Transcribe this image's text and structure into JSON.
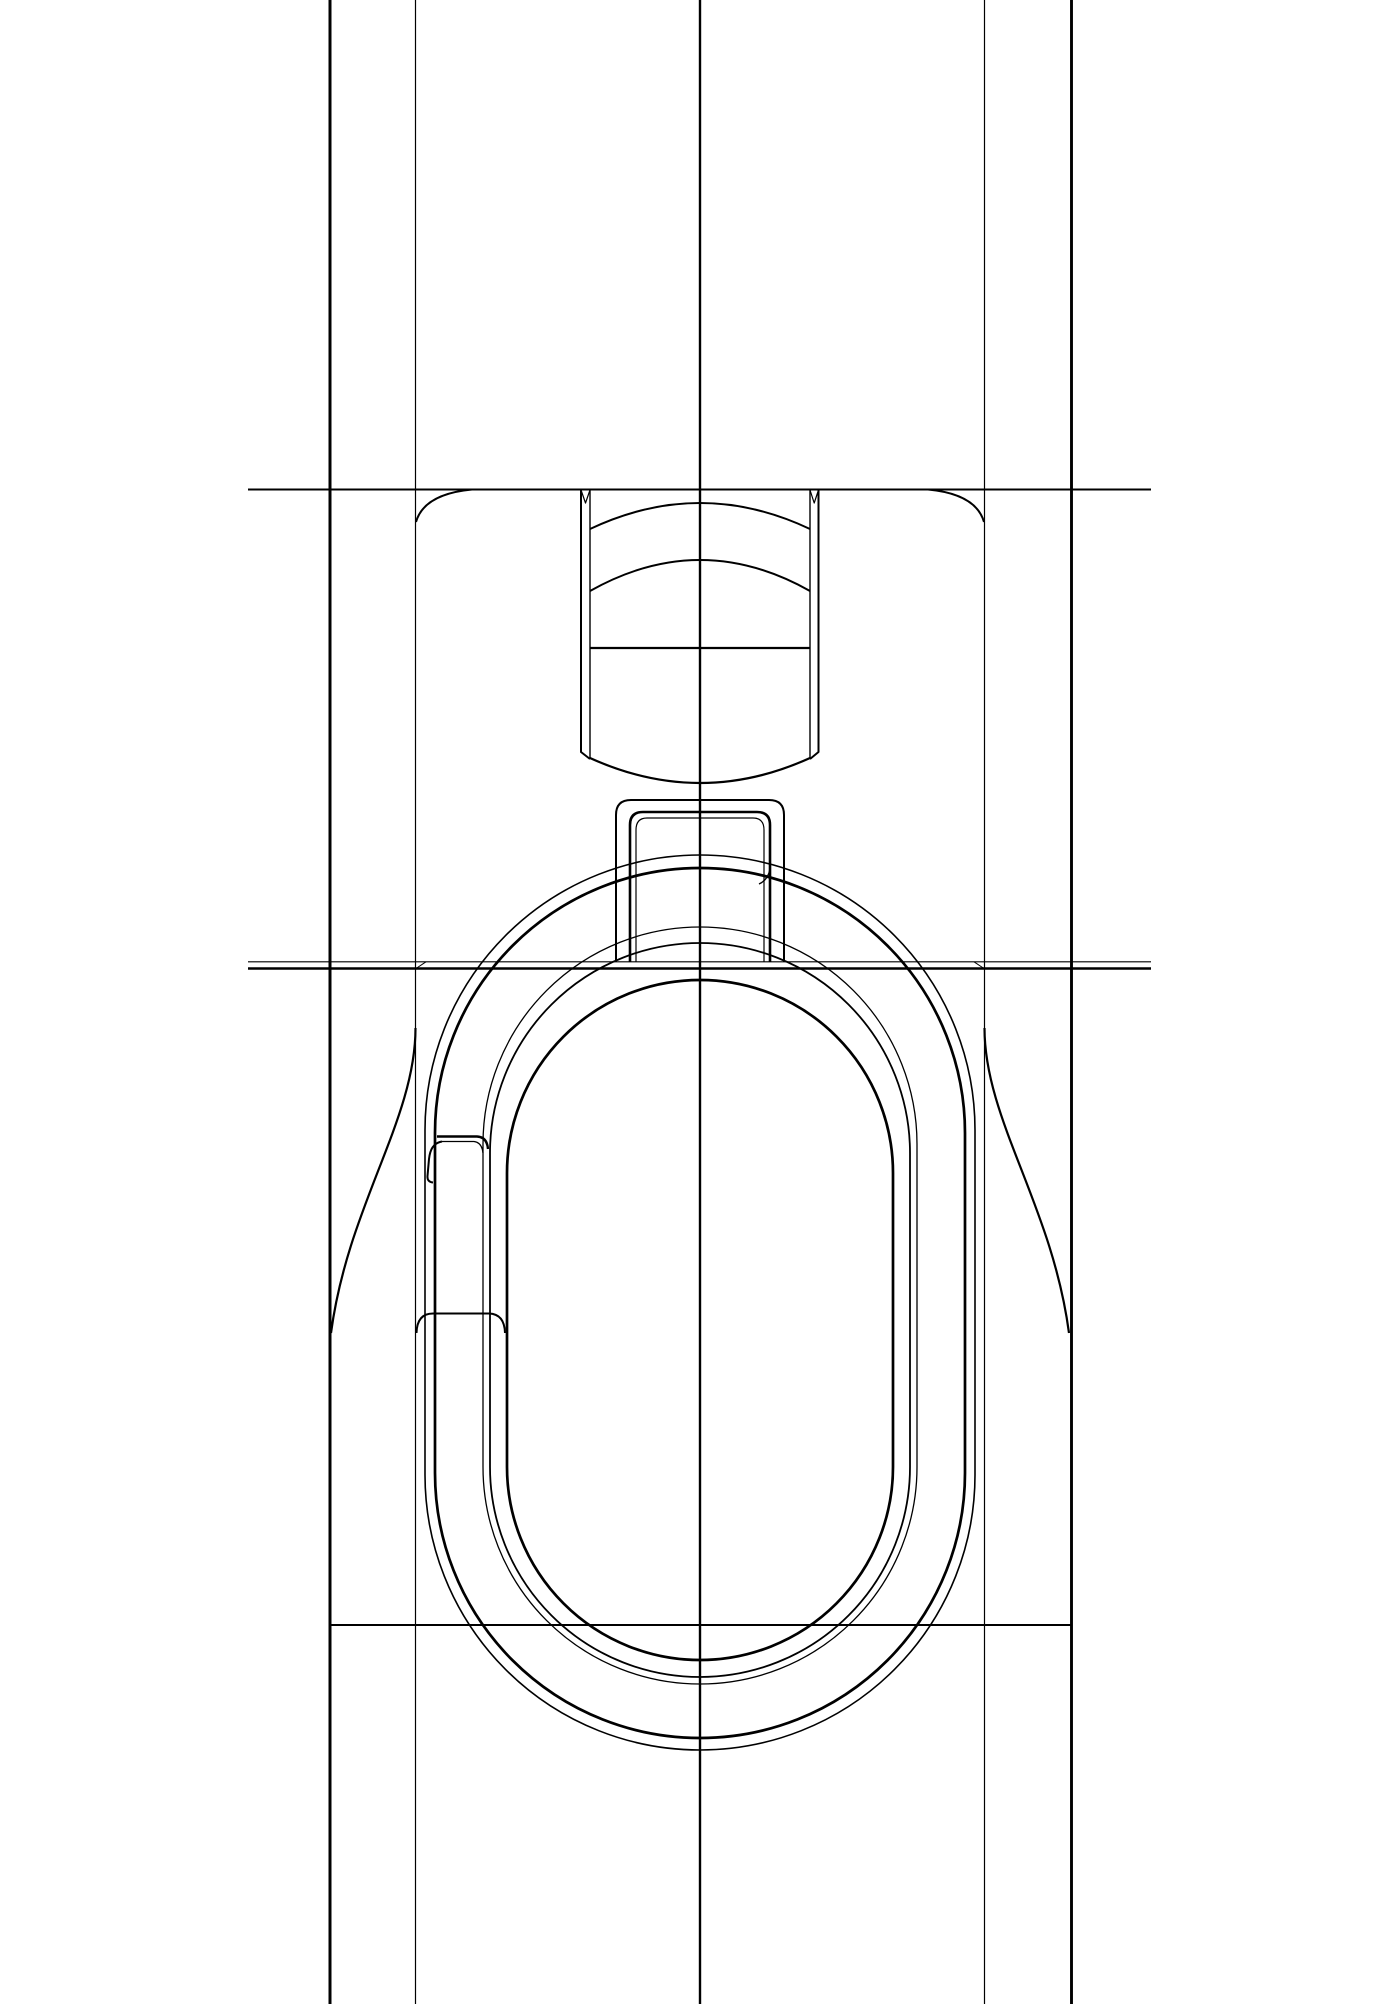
{
  "title": "Technical line drawing - zipper slider with obround pull ring (front elevation)",
  "canvas": {
    "width": 1400,
    "height": 2004,
    "background": "#ffffff",
    "line_color": "#000000"
  },
  "geometry": {
    "vlines": [
      {
        "name": "flange-edge-left-line",
        "x": 330,
        "y1": 0,
        "y2": 2004,
        "w": 3.0
      },
      {
        "name": "body-edge-left-line",
        "x": 415.5,
        "y1": 0,
        "y2": 2004,
        "w": 1.2
      },
      {
        "name": "center-line",
        "x": 700,
        "y1": 0,
        "y2": 2004,
        "w": 2.4
      },
      {
        "name": "body-edge-right-line",
        "x": 984.5,
        "y1": 0,
        "y2": 2004,
        "w": 1.2
      },
      {
        "name": "flange-edge-right-line",
        "x": 1071.5,
        "y1": 0,
        "y2": 2004,
        "w": 2.9
      }
    ],
    "hlines": [
      {
        "name": "top-plate-line",
        "y": 489.5,
        "x1": 248,
        "x2": 1151,
        "w": 2.0
      },
      {
        "name": "shoulder-line-upper",
        "y": 961.8,
        "x1": 248,
        "x2": 1151,
        "w": 1.2
      },
      {
        "name": "shoulder-line-lower",
        "y": 968.5,
        "x1": 248,
        "x2": 1151,
        "w": 2.6
      },
      {
        "name": "flange-bottom-line",
        "y": 1625,
        "x1": 330,
        "x2": 1072,
        "w": 2.0
      }
    ],
    "rounded_rects": [
      {
        "name": "ring-outer-outline",
        "x": 425,
        "y": 855,
        "width": 550,
        "height": 895,
        "r": 275,
        "w": 1.6
      },
      {
        "name": "ring-lip-outline",
        "x": 435,
        "y": 868,
        "width": 530,
        "height": 870,
        "r": 265,
        "w": 2.7
      },
      {
        "name": "ring-inner-outline-a",
        "x": 483,
        "y": 927,
        "width": 434,
        "height": 757,
        "r": 217,
        "w": 1.3
      },
      {
        "name": "ring-inner-outline-b",
        "x": 490,
        "y": 943,
        "width": 420,
        "height": 734,
        "r": 210,
        "w": 1.8
      },
      {
        "name": "ring-opening-outline",
        "x": 507,
        "y": 980,
        "width": 386,
        "height": 680,
        "r": 193,
        "w": 2.7
      }
    ],
    "paths": [
      {
        "name": "body-corner-left",
        "d": "M 472,489.5 Q 424,494 416,522",
        "w": 2.0
      },
      {
        "name": "body-corner-right",
        "d": "M 928,489.5 Q 976,494 984,522",
        "w": 2.0
      },
      {
        "name": "flare-curve-left",
        "d": "M 415.5,1028 C 415.5,1120 348,1205 331,1333",
        "w": 2.2
      },
      {
        "name": "flare-curve-right",
        "d": "M 984.5,1028 C 984.5,1120 1052,1205 1069,1333",
        "w": 2.2
      },
      {
        "name": "neck-wall-left-outer",
        "d": "M 581,489.5 L 581,752 L 590,759",
        "w": 2.0
      },
      {
        "name": "neck-wall-left-inner",
        "d": "M 590,489.5 L 590,758",
        "w": 1.4
      },
      {
        "name": "neck-wall-right-outer",
        "d": "M 818.5,489.5 L 818.5,752 L 810,759",
        "w": 2.0
      },
      {
        "name": "neck-wall-right-inner",
        "d": "M 810,489.5 L 810,758",
        "w": 1.4
      },
      {
        "name": "neck-notch-left",
        "d": "M 581,490 L 585.5,503 L 590,490",
        "w": 1.2
      },
      {
        "name": "neck-notch-right",
        "d": "M 810,490 L 814.2,503 L 818.5,490",
        "w": 1.2
      },
      {
        "name": "neck-arc-upper",
        "d": "M 590,529 Q 700,477 810,529",
        "w": 2.0
      },
      {
        "name": "neck-arc-lower",
        "d": "M 590,591 Q 700,529 810,591",
        "w": 2.0
      },
      {
        "name": "neck-chord-line",
        "d": "M 590,648 L 810,648",
        "w": 2.2
      },
      {
        "name": "neck-bottom-arc",
        "d": "M 590,758 Q 700,808 810,758",
        "w": 2.2
      },
      {
        "name": "bail-outer-outline",
        "d": "M 616,962 L 616,815 Q 616,800 631,800 L 769,800 Q 784,800 784,815 L 784,962",
        "w": 2.0
      },
      {
        "name": "bail-inner-outline-a",
        "d": "M 630,962 L 630,825 Q 630,812 643,812 L 757,812 Q 770,812 770,825 L 770,962",
        "w": 2.6
      },
      {
        "name": "bail-inner-outline-b",
        "d": "M 636,962 L 636,830 Q 636,818 647,818 L 753,818 Q 764,818 764,830 L 764,962",
        "w": 1.2
      },
      {
        "name": "gate-ledge-upper",
        "d": "M 437,1136.5 L 477,1136.5 Q 487,1137 488,1149",
        "w": 2.4
      },
      {
        "name": "gate-ledge-lower",
        "d": "M 442,1141.5 L 474,1141.5 Q 482,1142.5 483,1153",
        "w": 1.3
      },
      {
        "name": "gate-s-curve",
        "d": "M 442,1141.5 C 433,1143 430,1150 429,1159 L 427.5,1176 Q 427,1182 433,1182.5",
        "w": 2.0
      },
      {
        "name": "gate-bottom-bridge",
        "d": "M 416.5,1333 Q 417,1313.5 433,1313.5 L 489,1313.5 Q 504.5,1314 505,1333",
        "w": 2.0
      },
      {
        "name": "lip-bail-tick",
        "d": "M 759,884 Q 768,880 770,869",
        "w": 1.4
      },
      {
        "name": "shoulder-tick-left",
        "d": "M 416,968.5 L 426,961.8",
        "w": 1.0
      },
      {
        "name": "shoulder-tick-right",
        "d": "M 984,968.5 L 974,961.8",
        "w": 1.0
      }
    ]
  }
}
